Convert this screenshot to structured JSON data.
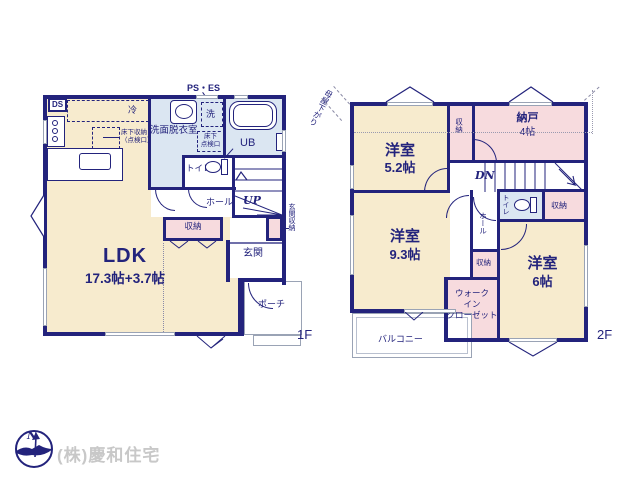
{
  "company": "(株)慶和住宅",
  "compass": {
    "n": "N"
  },
  "colors": {
    "wall": "#23237c",
    "room_cream": "#f7ebce",
    "room_blue": "#dbe6f2",
    "room_pink": "#f7dbde",
    "company_gray": "#c8c8c8"
  },
  "f1": {
    "tag": "1F",
    "ds": "DS",
    "ps_es": "PS・ES",
    "fridge": "冷",
    "underfloor_storage_1": "床下収納",
    "underfloor_storage_2": "（点検口）",
    "washroom": "洗面脱衣室",
    "washer": "洗",
    "hatch_1": "床下",
    "hatch_2": "点検口",
    "bath": "UB",
    "toilet": "トイレ",
    "hall": "ホール",
    "up": "UP",
    "storage": "収納",
    "entrance": "玄関",
    "entrance_storage": "玄関収納",
    "ldk": "LDK",
    "ldk_size": "17.3帖+3.7帖",
    "porch": "ポーチ"
  },
  "f2": {
    "tag": "2F",
    "eaves": "母屋下がり",
    "room_a": "洋室",
    "room_a_size": "5.2帖",
    "storage_a": "収納",
    "nando": "納戸",
    "nando_size": "4帖",
    "dn": "DN",
    "toilet": "トイレ",
    "storage_b": "収納",
    "hall": "ホール",
    "storage_c": "収納",
    "room_b": "洋室",
    "room_b_size": "9.3帖",
    "room_c": "洋室",
    "room_c_size": "6帖",
    "wic_1": "ウォーク",
    "wic_2": "イン",
    "wic_3": "クローゼット",
    "balcony": "バルコニー"
  }
}
